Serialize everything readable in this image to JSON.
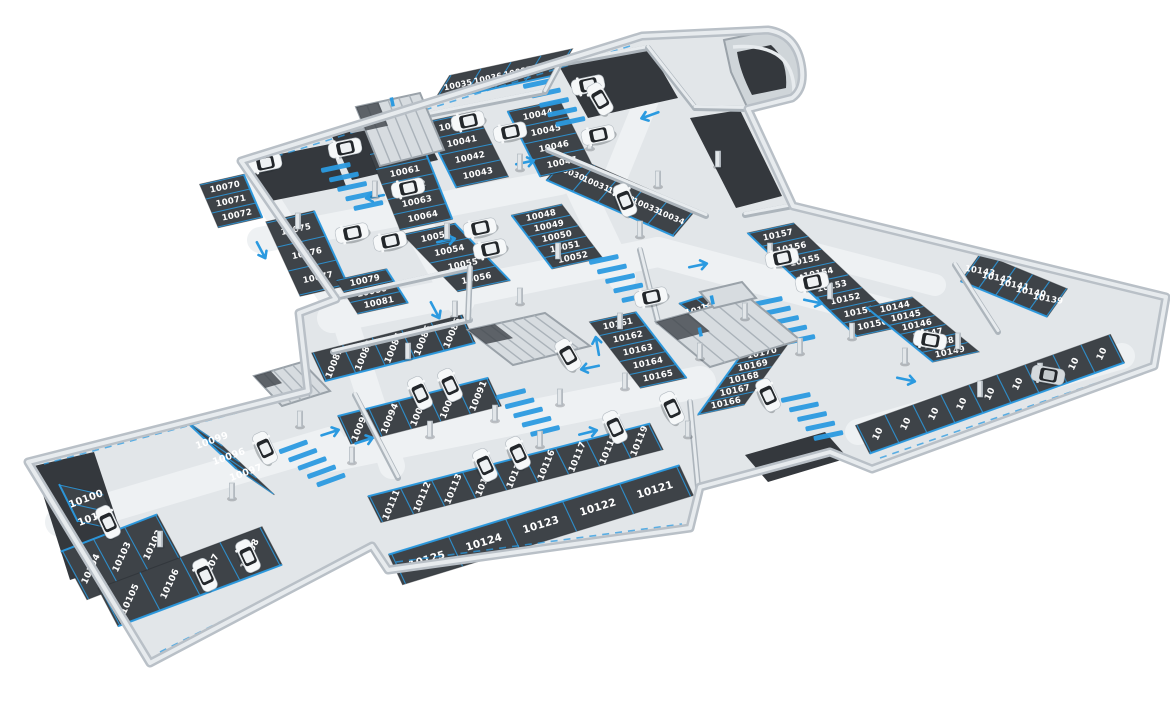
{
  "map": {
    "type": "isometric-underground-parking-garage-floor-plan",
    "background": "#ffffff",
    "colors": {
      "floor": "#e2e6e9",
      "lane": "#eef1f3",
      "asphalt": "#3e4348",
      "asphalt_dark": "#34383d",
      "wall": "#c6ccd1",
      "wall_light": "#e7ebee",
      "wall_edge": "#9aa2a9",
      "wall_line": "#adb5bc",
      "marking_blue": "#2b9ae0",
      "number_text": "#ffffff",
      "car_white": "#f6f8f9",
      "car_gray": "#d5dadd",
      "car_glass": "#23272b",
      "concrete_structure": "#d7dce0"
    },
    "bays": {
      "top_room": {
        "spots": [
          "10035",
          "10036",
          "10037",
          "10038"
        ]
      },
      "top_diag": {
        "spots": [
          "10030",
          "10031",
          "10032",
          "10033",
          "10034"
        ]
      },
      "col_40": {
        "spots": [
          "10040",
          "10041",
          "10042",
          "10043"
        ]
      },
      "col_44": {
        "spots": [
          "10044",
          "10045",
          "10046",
          "10047"
        ]
      },
      "col_48": {
        "spots": [
          "10048",
          "10049",
          "10050",
          "10051",
          "10052"
        ]
      },
      "col_53": {
        "spots": [
          "10053",
          "10054",
          "10055",
          "10056"
        ]
      },
      "col_60": {
        "spots": [
          "10060",
          "10061",
          "10062",
          "10063",
          "10064"
        ]
      },
      "col_70": {
        "spots": [
          "10070",
          "10071",
          "10072"
        ]
      },
      "col_75": {
        "spots": [
          "10075",
          "10076",
          "10077"
        ]
      },
      "col_79": {
        "spots": [
          "10079",
          "10080",
          "10081"
        ]
      },
      "row_82": {
        "spots": [
          "10082",
          "10083",
          "10084",
          "10085",
          "10086"
        ]
      },
      "row_91": {
        "spots": [
          "10095",
          "10094",
          "10093",
          "10092",
          "10091"
        ]
      },
      "row_96": {
        "spots": [
          "10099",
          "10096",
          "10097"
        ]
      },
      "col_100": {
        "spots": [
          "10100",
          "10101"
        ]
      },
      "col_102": {
        "spots": [
          "10104",
          "10103",
          "10102"
        ]
      },
      "row_105": {
        "spots": [
          "10105",
          "10106",
          "10107",
          "10108"
        ]
      },
      "row_111": {
        "spots": [
          "10111",
          "10112",
          "10113",
          "10114",
          "10115",
          "10116",
          "10117",
          "10118",
          "10119"
        ]
      },
      "row_121": {
        "spots": [
          "10125",
          "10124",
          "10123",
          "10122",
          "10121"
        ]
      },
      "col_161": {
        "spots": [
          "10161",
          "10162",
          "10163",
          "10164",
          "10165"
        ]
      },
      "col_166": {
        "spots": [
          "10166",
          "10167",
          "10168",
          "10169",
          "10170"
        ]
      },
      "pair_158": {
        "spots": [
          "10158",
          "10159"
        ]
      },
      "col_150": {
        "spots": [
          "10157",
          "10156",
          "10155",
          "10154",
          "10153",
          "10152",
          "10151",
          "10150"
        ]
      },
      "col_144": {
        "spots": [
          "10144",
          "10145",
          "10146",
          "10147",
          "10148",
          "10149"
        ]
      },
      "row_139": {
        "spots": [
          "10143",
          "10142",
          "10141",
          "10140",
          "10139"
        ]
      },
      "row_edge_br": {
        "spots": [
          "10",
          "10",
          "10",
          "10",
          "10",
          "10",
          "10",
          "10",
          "10"
        ]
      }
    },
    "cars": [
      {
        "x": 345,
        "y": 148,
        "heading": -12,
        "color": "white"
      },
      {
        "x": 265,
        "y": 163,
        "heading": -12,
        "color": "white"
      },
      {
        "x": 468,
        "y": 121,
        "heading": -12,
        "color": "white"
      },
      {
        "x": 510,
        "y": 132,
        "heading": -12,
        "color": "white"
      },
      {
        "x": 588,
        "y": 85,
        "heading": -12,
        "color": "white"
      },
      {
        "x": 600,
        "y": 99,
        "heading": 60,
        "color": "white"
      },
      {
        "x": 598,
        "y": 135,
        "heading": -12,
        "color": "white"
      },
      {
        "x": 625,
        "y": 200,
        "heading": 68,
        "color": "white"
      },
      {
        "x": 408,
        "y": 188,
        "heading": -12,
        "color": "white"
      },
      {
        "x": 480,
        "y": 228,
        "heading": -12,
        "color": "white"
      },
      {
        "x": 352,
        "y": 233,
        "heading": -12,
        "color": "white"
      },
      {
        "x": 390,
        "y": 241,
        "heading": -12,
        "color": "white"
      },
      {
        "x": 490,
        "y": 249,
        "heading": -12,
        "color": "white"
      },
      {
        "x": 568,
        "y": 355,
        "heading": 60,
        "color": "white"
      },
      {
        "x": 420,
        "y": 393,
        "heading": 65,
        "color": "white"
      },
      {
        "x": 450,
        "y": 385,
        "heading": 65,
        "color": "white"
      },
      {
        "x": 265,
        "y": 448,
        "heading": 65,
        "color": "white"
      },
      {
        "x": 108,
        "y": 522,
        "heading": 65,
        "color": "white"
      },
      {
        "x": 205,
        "y": 575,
        "heading": 65,
        "color": "white"
      },
      {
        "x": 248,
        "y": 556,
        "heading": 65,
        "color": "white"
      },
      {
        "x": 485,
        "y": 465,
        "heading": 65,
        "color": "white"
      },
      {
        "x": 518,
        "y": 453,
        "heading": 65,
        "color": "white"
      },
      {
        "x": 615,
        "y": 427,
        "heading": 65,
        "color": "white"
      },
      {
        "x": 672,
        "y": 408,
        "heading": 65,
        "color": "white"
      },
      {
        "x": 768,
        "y": 395,
        "heading": 65,
        "color": "white"
      },
      {
        "x": 651,
        "y": 297,
        "heading": -12,
        "color": "white"
      },
      {
        "x": 782,
        "y": 258,
        "heading": -12,
        "color": "white"
      },
      {
        "x": 812,
        "y": 282,
        "heading": -12,
        "color": "white"
      },
      {
        "x": 930,
        "y": 340,
        "heading": 10,
        "color": "white"
      },
      {
        "x": 1048,
        "y": 375,
        "heading": 10,
        "color": "gray"
      }
    ],
    "features": {
      "entrance_ramp": true,
      "stairwells": 4,
      "crosswalks": 7,
      "direction_arrows": 14,
      "pillars": 33
    }
  }
}
